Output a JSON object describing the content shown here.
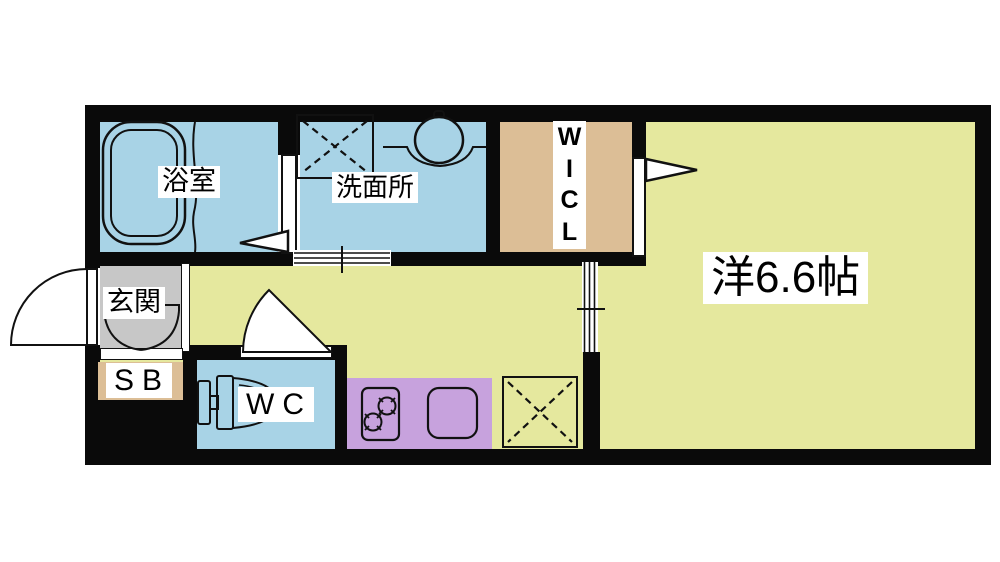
{
  "colors": {
    "page_background": "#ffffff",
    "wall_black": "#0a0a0a",
    "line_black": "#111111",
    "wet_area_blue": "#a8d3e6",
    "flooring_yellow_green": "#e5e89e",
    "closet_tan": "#dcbe96",
    "entrance_gray": "#c7c7c7",
    "kitchen_purple": "#c7a2dd",
    "label_background": "#ffffff"
  },
  "labels": {
    "bathroom": "浴室",
    "washroom": "洗面所",
    "wicl_chars": [
      "W",
      "I",
      "C",
      "L"
    ],
    "western_room": "洋6.6帖",
    "entrance": "玄関",
    "shoe_box": "SB",
    "water_closet": "WC"
  },
  "fixtures": [
    "bathtub",
    "washing-machine-space",
    "washbasin",
    "bathroom-folding-door",
    "washroom-sliding-door",
    "wicl-door",
    "room-sliding-door",
    "wc-door",
    "entrance-door",
    "shoe-cabinet-doors",
    "toilet",
    "gas-stove",
    "kitchen-sink",
    "refrigerator-space"
  ]
}
